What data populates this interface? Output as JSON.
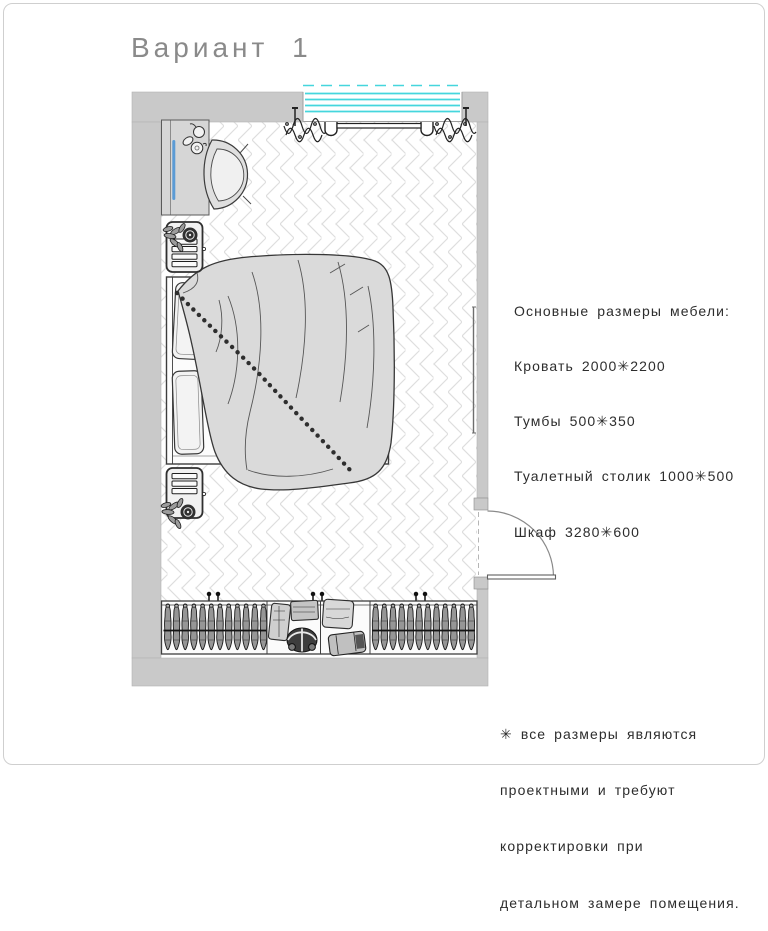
{
  "title": "Вариант 1",
  "furniture_notes": {
    "header": "Основные размеры мебели:",
    "items": [
      "Кровать 2000✳2200",
      "Тумбы 500✳350",
      "Туалетный столик 1000✳500",
      "Шкаф 3280✳600"
    ]
  },
  "footnote": {
    "lines": [
      "✳ все размеры являются",
      "проектными и требуют",
      "корректировки при",
      "детальном замере помещения."
    ]
  },
  "plan_symbols": {
    "window": "window-with-curtains",
    "door": "outward-swing-door",
    "bed": "double-bed-with-blanket-and-pillows",
    "nightstands": "nightstand-with-plant",
    "dressing_table": "dressing-table-with-mirror-and-chair",
    "wardrobe": "wardrobe-with-hangers-and-shelves",
    "radiator": "wall-radiator",
    "floor": "herringbone-parquet"
  },
  "colors": {
    "wall_fill": "#c9c9c9",
    "window_glass": "#45d6dd",
    "mirror_accent": "#5b9bd5",
    "outline": "#3a3a3a",
    "furniture_fill": "#d9d9d9",
    "floor_line": "#dedede",
    "title_text": "#8a8a8a",
    "body_text": "#2d2d2d",
    "frame_border": "#cfcfcf"
  }
}
